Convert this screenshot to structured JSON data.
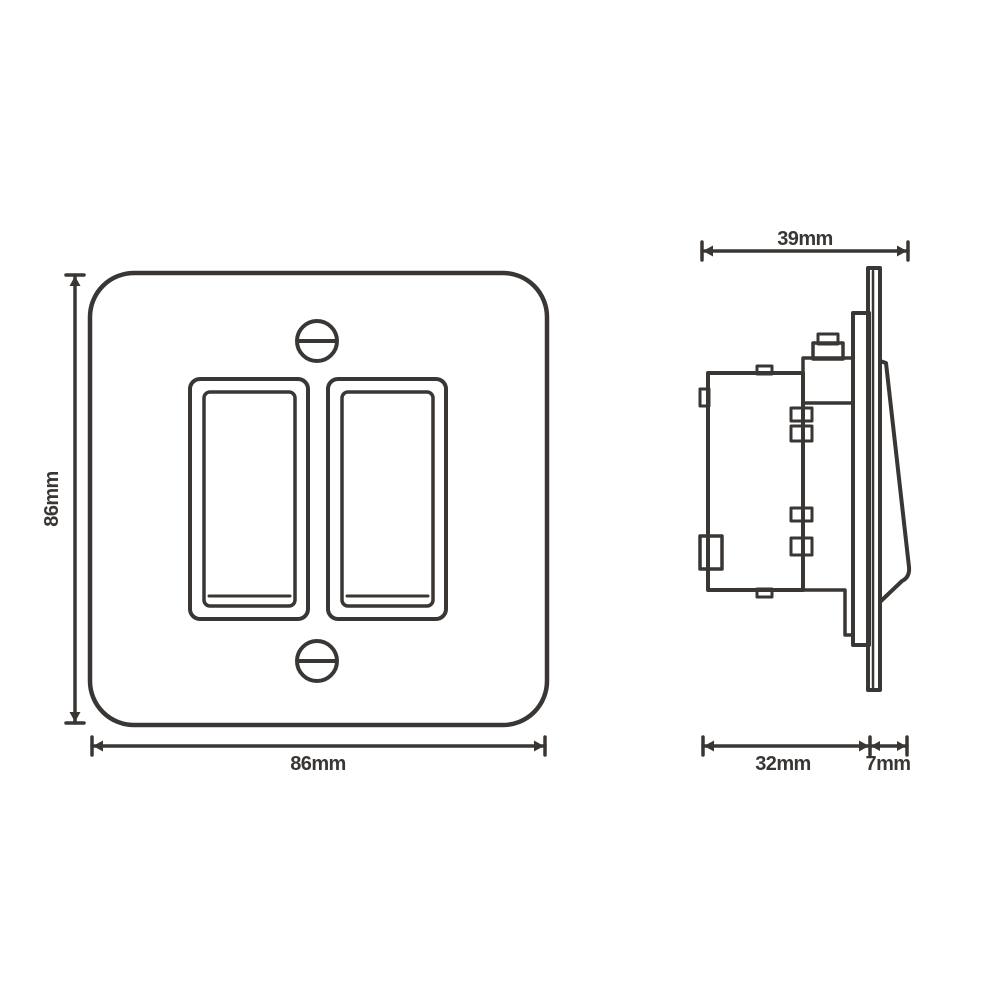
{
  "palette": {
    "line_color": "#3a3633",
    "background_color": "#ffffff"
  },
  "front_view": {
    "height_label": "86mm",
    "width_label": "86mm"
  },
  "side_view": {
    "overall_depth_label": "39mm",
    "body_depth_label": "32mm",
    "projection_label": "7mm"
  }
}
